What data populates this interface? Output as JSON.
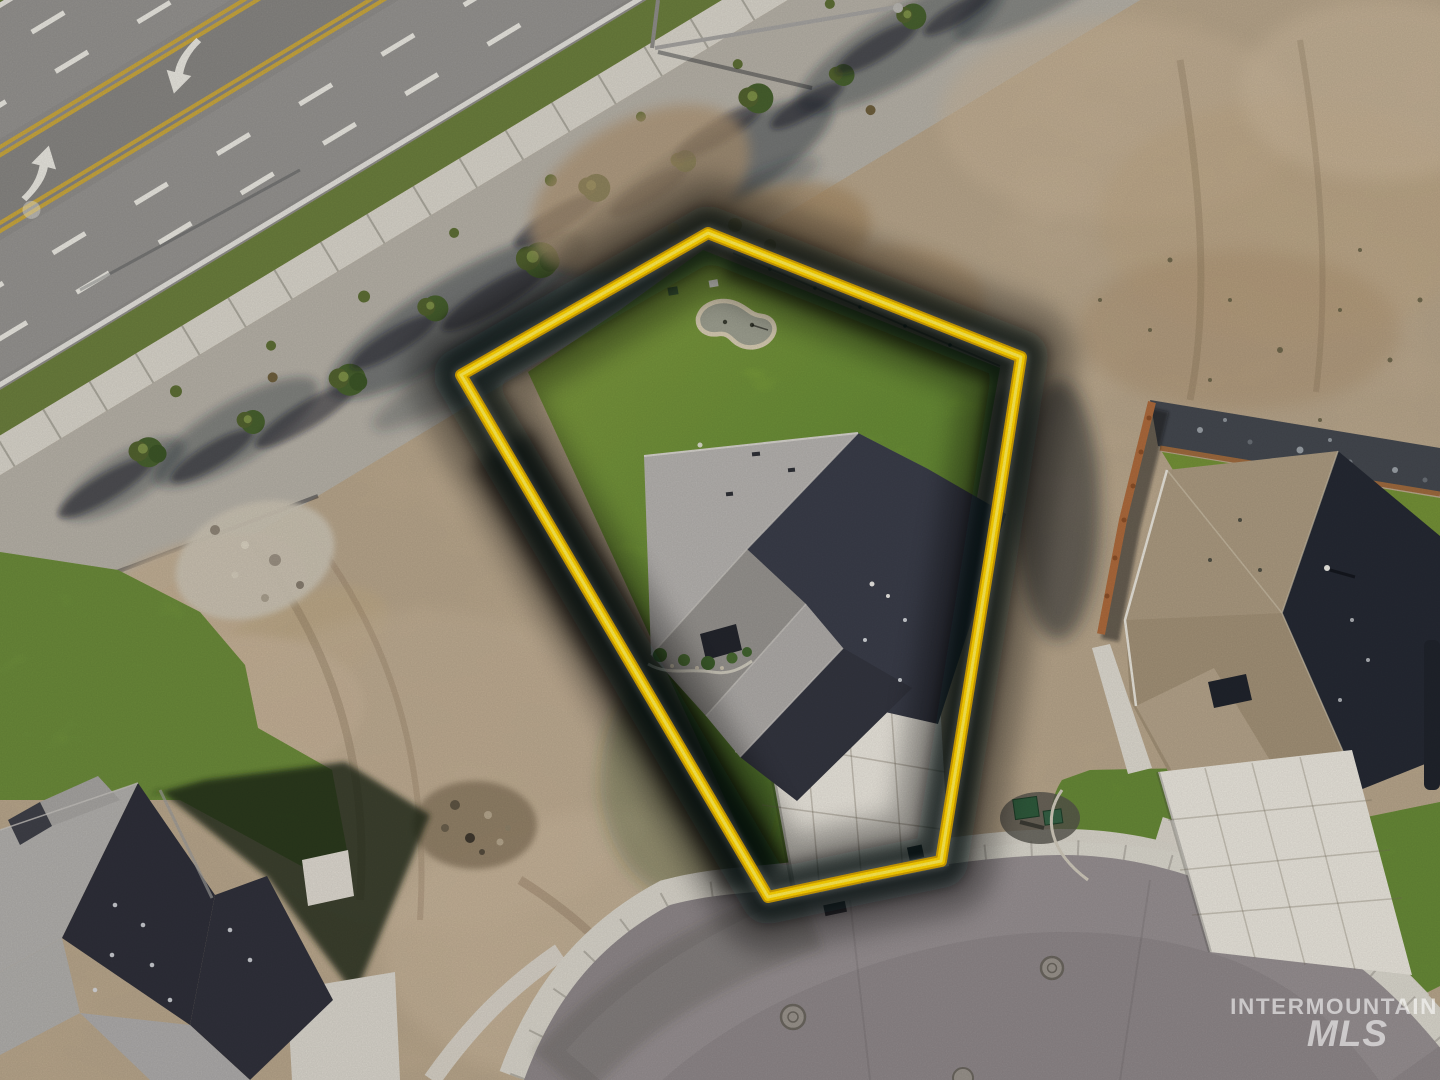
{
  "watermark": {
    "line1": "INTERMOUNTAIN",
    "line2": "MLS"
  },
  "scene": {
    "type": "aerial-drone-real-estate-photo",
    "subject": "corner residential lot outlined in yellow containing a new single-family home, back lawn with small putting green, and concrete driveway",
    "surroundings": [
      "multi-lane arterial road with double yellow lines, dashed lane lines and turn arrows (upper left)",
      "landscaped gravel strip with evergreen trees and sidewalk along arterial",
      "vacant graded dirt lots (left and upper right)",
      "curved residential street with concrete curb, sidewalk and manhole covers (bottom)",
      "neighboring house with dark gray roof (bottom left)",
      "neighboring house with tan roof, rear fence and concrete driveway (right)",
      "green utility boxes near right lot line"
    ]
  },
  "colors": {
    "boundary_yellow": "#ffd400",
    "boundary_core": "#ffef5e",
    "boundary_under": "#d9a400",
    "glow_dark": "#05080c",
    "lawn_green": "#7ca338",
    "lawn_light": "#a0b545",
    "lawn_dark": "#5e8a2c",
    "dirt_tan": "#c2af94",
    "dirt_brown": "#a58a66",
    "gravel_gray": "#b6b1a7",
    "road_asphalt": "#8f8d8a",
    "street_asphalt": "#8e8789",
    "concrete_light": "#d8d4ca",
    "driveway_white": "#e9e5dc",
    "roof_sunlit_gray": "#b5b2af",
    "roof_mid_gray": "#96938f",
    "roof_shadow_navy": "#3a3d49",
    "left_roof_light": "#b1afac",
    "left_roof_dark": "#2e2f39",
    "neighbor_roof_tan": "#ab9a80",
    "neighbor_roof_dark": "#252933",
    "tree_green": "#47602e",
    "utility_box_green": "#2f5a3c",
    "fence_rust": "#ad6a3c",
    "putting_green_surface": "#9d9f90",
    "putting_green_border": "#d6cbb2",
    "lane_yellow": "#c8a63e",
    "lane_white": "#e9e7e0",
    "watermark_white": "rgba(255,255,255,0.58)"
  }
}
